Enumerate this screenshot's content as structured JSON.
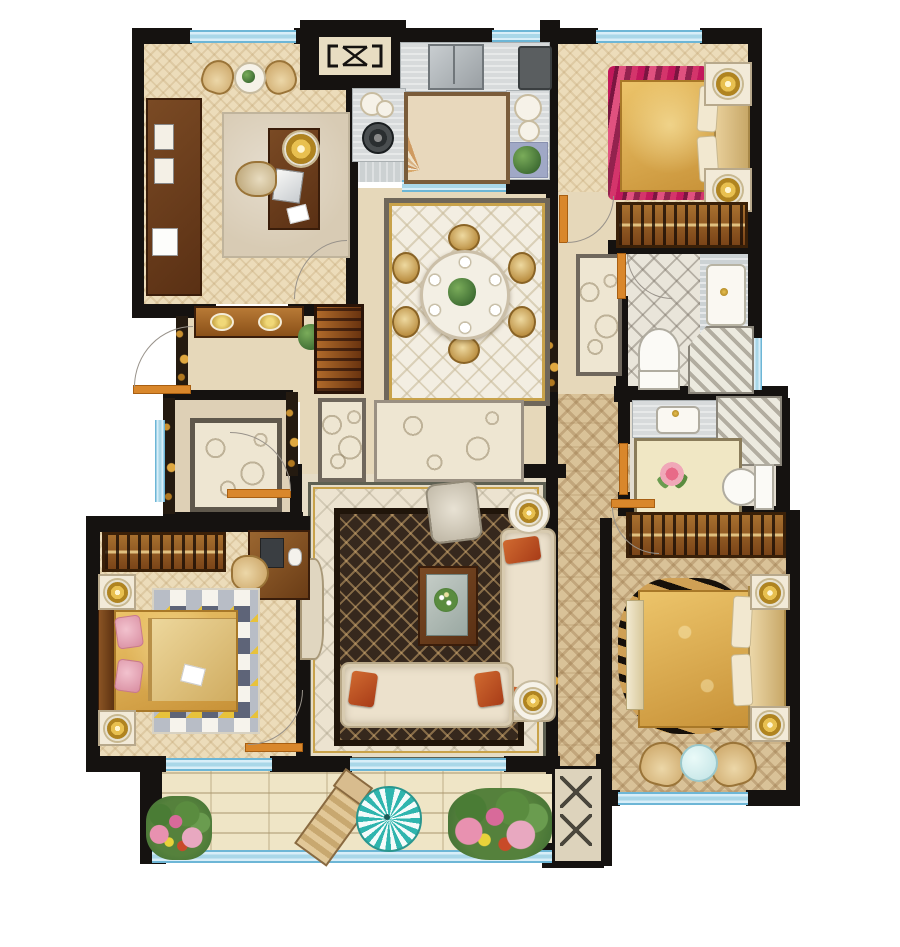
{
  "palette": {
    "wall": "#151210",
    "window": "#a9d7e8",
    "door": "#d9872b",
    "wood": "#7a4a24",
    "wood-dark": "#4a2c12",
    "gold": "#d4a947",
    "teal": "#2fb5ae",
    "magenta": "#c2185b",
    "cream": "#ece1cc",
    "orange": "#c05a28",
    "plant": "#4a7c35",
    "flower": "#e891b0",
    "floor-wood": "#ecdcba",
    "floor-gray": "#ccd1d2",
    "brick": "#efe5c6"
  },
  "rooms": [
    {
      "id": "study",
      "name": "study",
      "items": [
        "bookshelf",
        "armchair",
        "armchair",
        "tea-table",
        "area-rug",
        "desk",
        "desk-lamp",
        "laptop",
        "desk-chair",
        "paper"
      ]
    },
    {
      "id": "elevator-core",
      "name": "elevator core",
      "items": [
        "elevator-symbol"
      ]
    },
    {
      "id": "kitchen",
      "name": "kitchen",
      "items": [
        "double-sink",
        "refrigerator",
        "counter",
        "cooktop",
        "dish-set",
        "plates",
        "plant",
        "fan-tile-mat",
        "mat"
      ]
    },
    {
      "id": "bedroom-2",
      "name": "bedroom 2",
      "items": [
        "magenta-rug",
        "double-bed",
        "headboard",
        "pillows",
        "nightstand",
        "nightstand",
        "table-lamp",
        "table-lamp",
        "wardrobe"
      ]
    },
    {
      "id": "guest-bathroom",
      "name": "guest bathroom",
      "items": [
        "toilet",
        "shower",
        "vanity-sink",
        "runner-rug"
      ]
    },
    {
      "id": "dining-room",
      "name": "dining room",
      "items": [
        "area-rug",
        "round-table",
        "centerpiece",
        "dining-chair",
        "dining-chair",
        "dining-chair",
        "dining-chair",
        "dining-chair",
        "dining-chair"
      ]
    },
    {
      "id": "foyer",
      "name": "foyer",
      "items": [
        "entry-door",
        "console-table",
        "console-lamps",
        "shoe-cabinet",
        "plant"
      ]
    },
    {
      "id": "multipurpose-room",
      "name": "multipurpose room",
      "items": [
        "swirl-rug",
        "door",
        "window"
      ]
    },
    {
      "id": "hallway",
      "name": "hallway",
      "items": [
        "swirl-rug",
        "nook-rug"
      ]
    },
    {
      "id": "living-room",
      "name": "living room",
      "items": [
        "dark-lattice-rug",
        "armchair",
        "coffee-table",
        "flower-vase",
        "sofa",
        "chaise-sofa",
        "throw-pillows",
        "side-table",
        "side-table",
        "table-lamp",
        "table-lamp",
        "tv-console"
      ]
    },
    {
      "id": "bedroom-3",
      "name": "bedroom 3",
      "items": [
        "wardrobe",
        "desk",
        "desk-chair",
        "computer",
        "triangle-rug",
        "double-bed",
        "pink-pillows",
        "nightstand",
        "nightstand",
        "table-lamp",
        "table-lamp"
      ]
    },
    {
      "id": "master-bathroom",
      "name": "master bathroom",
      "items": [
        "vanity-sink",
        "shower",
        "floral-floor-panel",
        "toilet"
      ]
    },
    {
      "id": "master-bedroom",
      "name": "master bedroom",
      "items": [
        "wardrobe",
        "zebra-rug",
        "double-bed",
        "bed-bench",
        "headboard",
        "nightstand",
        "nightstand",
        "table-lamp",
        "table-lamp",
        "armchair",
        "armchair",
        "tea-table"
      ]
    },
    {
      "id": "balcony",
      "name": "balcony",
      "items": [
        "lounge-chair",
        "parasol",
        "flower-bed",
        "flower-bed",
        "equipment-platform"
      ]
    }
  ]
}
